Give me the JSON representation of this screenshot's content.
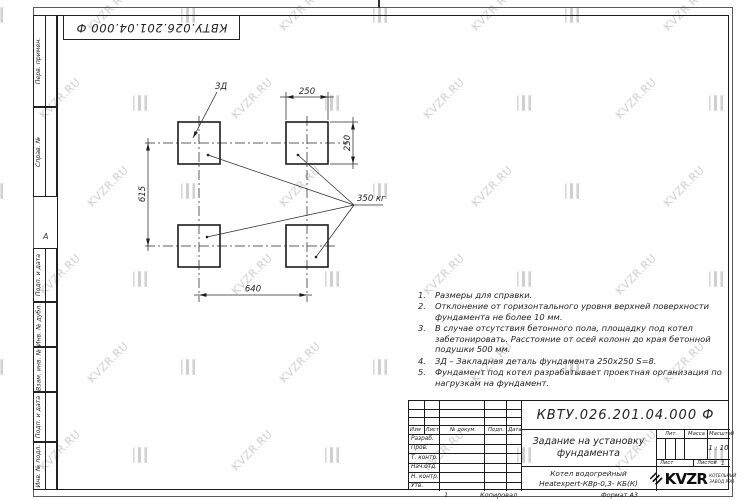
{
  "watermark": {
    "text": "KVZR.RU"
  },
  "frame": {
    "fold_mark": "А",
    "margin_labels": [
      "Перв. примен.",
      "Справ. №",
      "Подп. и дата",
      "Инв. № дубл.",
      "Взам. инв. №",
      "Подп. и дата",
      "Инв. № подл."
    ]
  },
  "stamp": {
    "designation": "КВТУ.026.201.04.000 Ф"
  },
  "drawing": {
    "detail_label": "ЗД",
    "load_label": "350 кг",
    "dim_top": "250",
    "dim_right": "250",
    "dim_left": "615",
    "dim_bottom": "640"
  },
  "notes": [
    {
      "num": "1.",
      "text": "Размеры для справки."
    },
    {
      "num": "2.",
      "text": "Отклонение от горизонтального уровня верхней поверхности\nфундамента не более 10 мм."
    },
    {
      "num": "3.",
      "text": "В случае отсутствия бетонного пола, площадку под котел\nзабетонировать. Расстояние от осей колонн до края бетонной\nподушки 500 мм."
    },
    {
      "num": "4.",
      "text": "ЗД – Закладная деталь фундамента 250х250 S=8."
    },
    {
      "num": "5.",
      "text": "Фундамент под котел разрабатывает проектная организация по\nнагрузкам на фундамент."
    }
  ],
  "title_block": {
    "designation": "КВТУ.026.201.04.000 Ф",
    "title_line1": "Задание на установку",
    "title_line2": "фундамента",
    "product_line1": "Котел водогрейный",
    "product_line2": "Heatexpert-КВр-0,3- КБ(К)",
    "col_izm": "Изм",
    "col_list": "Лист",
    "col_doc": "№ докум.",
    "col_podp": "Подп.",
    "col_data": "Дата",
    "row_razrab": "Разраб.",
    "row_prov": "Пров.",
    "row_tkontr": "Т. контр.",
    "row_nachotd": "Нач.отд.",
    "row_nkontr": "Н. контр.",
    "row_utv": "Утв.",
    "lit_label": "Лит.",
    "mass_label": "Масса",
    "scale_label": "Масштаб",
    "scale_value": "1 : 10",
    "sheet_label": "Лист",
    "sheets_label": "Листов",
    "sheets_value": "1",
    "logo_text": "KVZR",
    "logo_sub1": "КОТЕЛЬНЫЙ",
    "logo_sub2": "ЗАВОД РЭП",
    "copy_num": "1",
    "copied_label": "Копировал",
    "format_label": "Формат А3"
  }
}
